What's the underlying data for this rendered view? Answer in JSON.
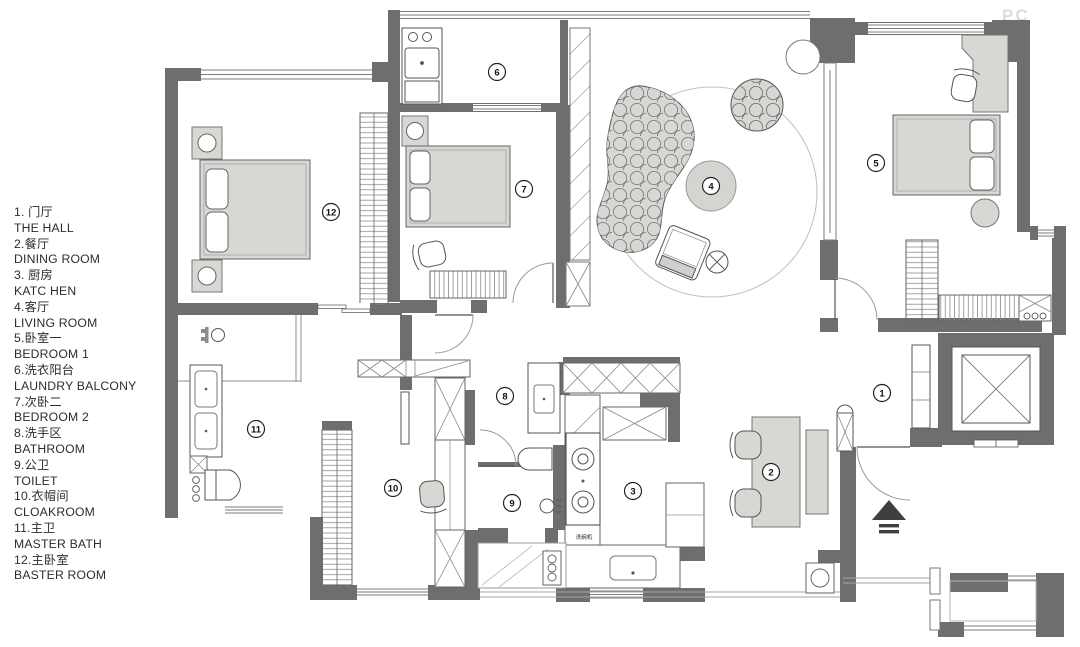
{
  "watermark": "PC",
  "legend_items": [
    {
      "zh": "1. 门厅",
      "en": "THE HALL"
    },
    {
      "zh": "2.餐厅",
      "en": "DINING ROOM"
    },
    {
      "zh": "3. 厨房",
      "en": "KATC HEN"
    },
    {
      "zh": "4.客厅",
      "en": "LIVING ROOM"
    },
    {
      "zh": "5.卧室一",
      "en": "BEDROOM 1"
    },
    {
      "zh": "6.洗衣阳台",
      "en": "LAUNDRY BALCONY"
    },
    {
      "zh": "7.次卧二",
      "en": "BEDROOM 2"
    },
    {
      "zh": "8.洗手区",
      "en": "BATHROOM"
    },
    {
      "zh": "9.公卫",
      "en": "TOILET"
    },
    {
      "zh": "10.衣帽间",
      "en": "CLOAKROOM"
    },
    {
      "zh": "11.主卫",
      "en": "MASTER BATH"
    },
    {
      "zh": "12.主卧室",
      "en": "BASTER ROOM"
    }
  ],
  "room_markers": {
    "hall": "1",
    "dining": "2",
    "kitchen": "3",
    "living": "4",
    "bedroom1": "5",
    "laundry_balcony": "6",
    "bedroom2": "7",
    "wash_area": "8",
    "toilet": "9",
    "cloakroom": "10",
    "master_bath": "11",
    "master_bedroom": "12"
  },
  "kitchen_appliance_label": "洗碗机",
  "colors": {
    "wall": "#6e6e6e",
    "furniture": "#d7d7d4",
    "line": "#555555"
  }
}
